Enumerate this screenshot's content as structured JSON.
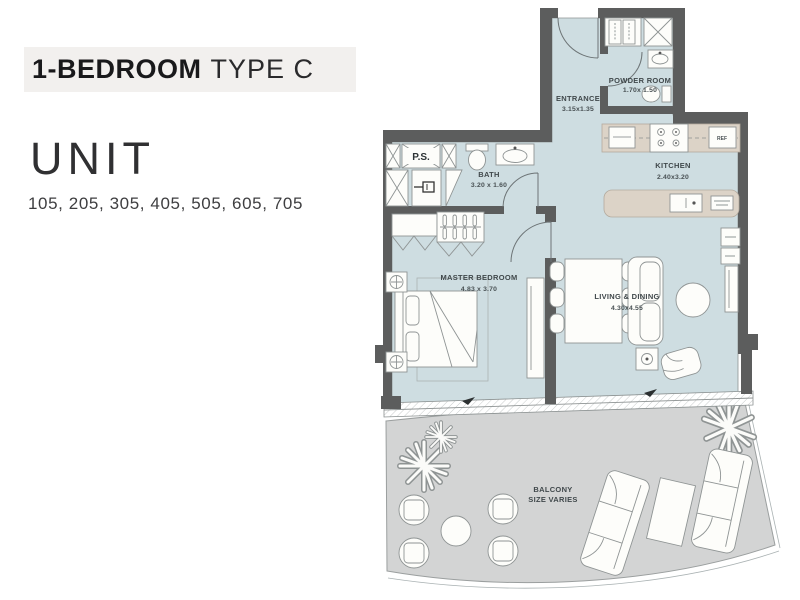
{
  "panel": {
    "title_bold": "1-BEDROOM",
    "title_regular": "TYPE C",
    "unit_heading": "UNIT",
    "unit_numbers": "105, 205, 305, 405, 505, 605, 705"
  },
  "plan": {
    "rooms": {
      "entrance": {
        "name": "ENTRANCE",
        "dims": "3.15x1.35"
      },
      "powder": {
        "name": "POWDER ROOM",
        "dims": "1.70x 1.50"
      },
      "kitchen": {
        "name": "KITCHEN",
        "dims": "2.40x3.20"
      },
      "bath": {
        "name": "BATH",
        "dims": "3.20 x 1.60"
      },
      "master": {
        "name": "MASTER BEDROOM",
        "dims": "4.83 x 3.70"
      },
      "living": {
        "name": "LIVING & DINING",
        "dims": "4.30x4.55"
      },
      "balcony": {
        "name": "BALCONY",
        "dims": "SIZE VARIES"
      }
    },
    "labels": {
      "ps": "P.S.",
      "ref": "REF"
    },
    "colors": {
      "wall": "#5c5d5d",
      "floor": "#cedde1",
      "counter": "#dcd3c7",
      "balcony_floor": "#d3d4d4",
      "outline": "#8f9494",
      "title_strip_bg": "#f2f0ee"
    }
  }
}
